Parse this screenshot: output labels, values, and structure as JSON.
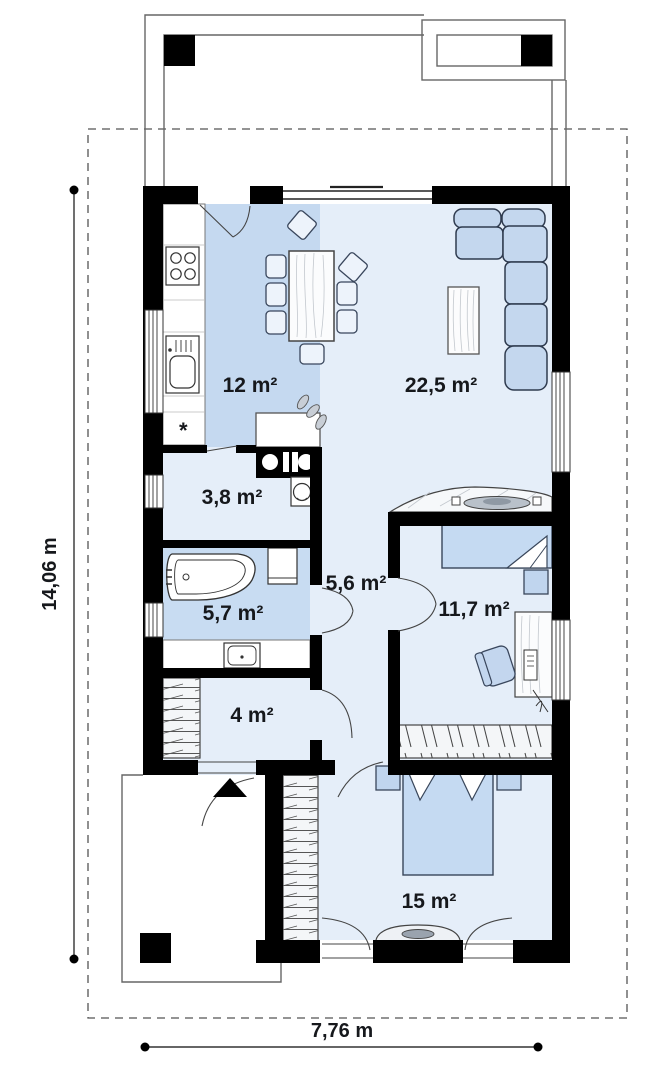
{
  "plan": {
    "type": "house-floor-plan",
    "rooms": [
      {
        "id": "kitchen-dining",
        "label": "12 m²"
      },
      {
        "id": "living-room",
        "label": "22,5 m²"
      },
      {
        "id": "utility",
        "label": "3,8 m²"
      },
      {
        "id": "bathroom",
        "label": "5,7 m²"
      },
      {
        "id": "hall",
        "label": "5,6 m²"
      },
      {
        "id": "office-bedroom",
        "label": "11,7 m²"
      },
      {
        "id": "entry",
        "label": "4 m²"
      },
      {
        "id": "bedroom",
        "label": "15 m²"
      }
    ],
    "dimensions": {
      "overall_height": "14,06 m",
      "overall_width": "7,76 m"
    },
    "kitchen_note": "*",
    "colors": {
      "wall": "#000000",
      "room_light": "#e5eef9",
      "room_accent": "#c5d9f0",
      "furniture_blue": "#c4d7ee",
      "furniture_border": "#2f3b4f",
      "outline_gray": "#555555"
    }
  }
}
